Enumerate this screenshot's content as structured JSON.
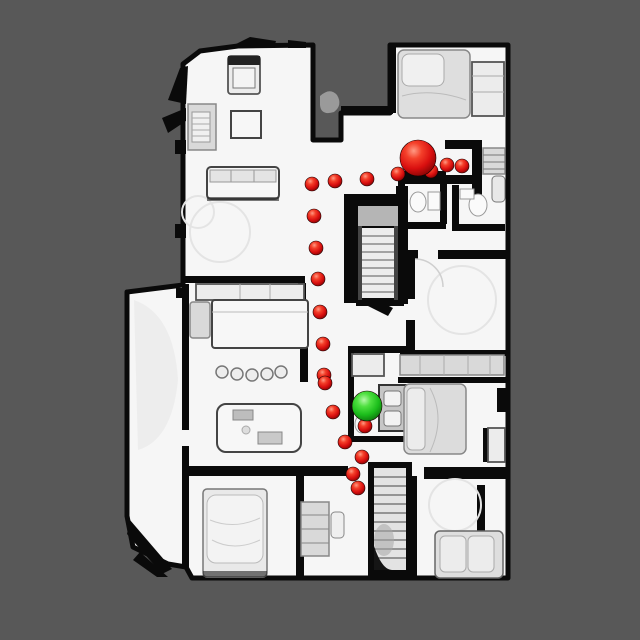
{
  "scene": {
    "view": "top-down-house-scan",
    "marker_count_path": 20
  },
  "colors": {
    "background": "#585858",
    "floor": "#f6f6f6",
    "wall": "#0a0a0a",
    "path_marker_base": "#d90f0f",
    "goal_marker_base": "#1bbd1b",
    "red_gradient": [
      "#ff9a84",
      "#f4402a",
      "#d90f0f",
      "#730202"
    ],
    "green_gradient": [
      "#b4f8a8",
      "#4fe040",
      "#1bbd1b",
      "#0a640a"
    ]
  },
  "markers": {
    "agent_start": {
      "name": "agent-position-sphere",
      "x": 418,
      "y": 158,
      "r": 18
    },
    "goal": {
      "name": "goal-position-sphere",
      "x": 367,
      "y": 406,
      "r": 15
    },
    "path_points": [
      {
        "x": 312,
        "y": 184,
        "r": 7
      },
      {
        "x": 335,
        "y": 181,
        "r": 7
      },
      {
        "x": 367,
        "y": 179,
        "r": 7
      },
      {
        "x": 398,
        "y": 174,
        "r": 7
      },
      {
        "x": 431,
        "y": 171,
        "r": 7
      },
      {
        "x": 447,
        "y": 165,
        "r": 7
      },
      {
        "x": 462,
        "y": 166,
        "r": 7
      },
      {
        "x": 314,
        "y": 216,
        "r": 7
      },
      {
        "x": 316,
        "y": 248,
        "r": 7
      },
      {
        "x": 318,
        "y": 279,
        "r": 7
      },
      {
        "x": 320,
        "y": 312,
        "r": 7
      },
      {
        "x": 323,
        "y": 344,
        "r": 7
      },
      {
        "x": 324,
        "y": 375,
        "r": 7
      },
      {
        "x": 325,
        "y": 383,
        "r": 7
      },
      {
        "x": 333,
        "y": 412,
        "r": 7
      },
      {
        "x": 365,
        "y": 426,
        "r": 7
      },
      {
        "x": 345,
        "y": 442,
        "r": 7
      },
      {
        "x": 362,
        "y": 457,
        "r": 7
      },
      {
        "x": 353,
        "y": 474,
        "r": 7
      },
      {
        "x": 358,
        "y": 488,
        "r": 7
      }
    ]
  }
}
